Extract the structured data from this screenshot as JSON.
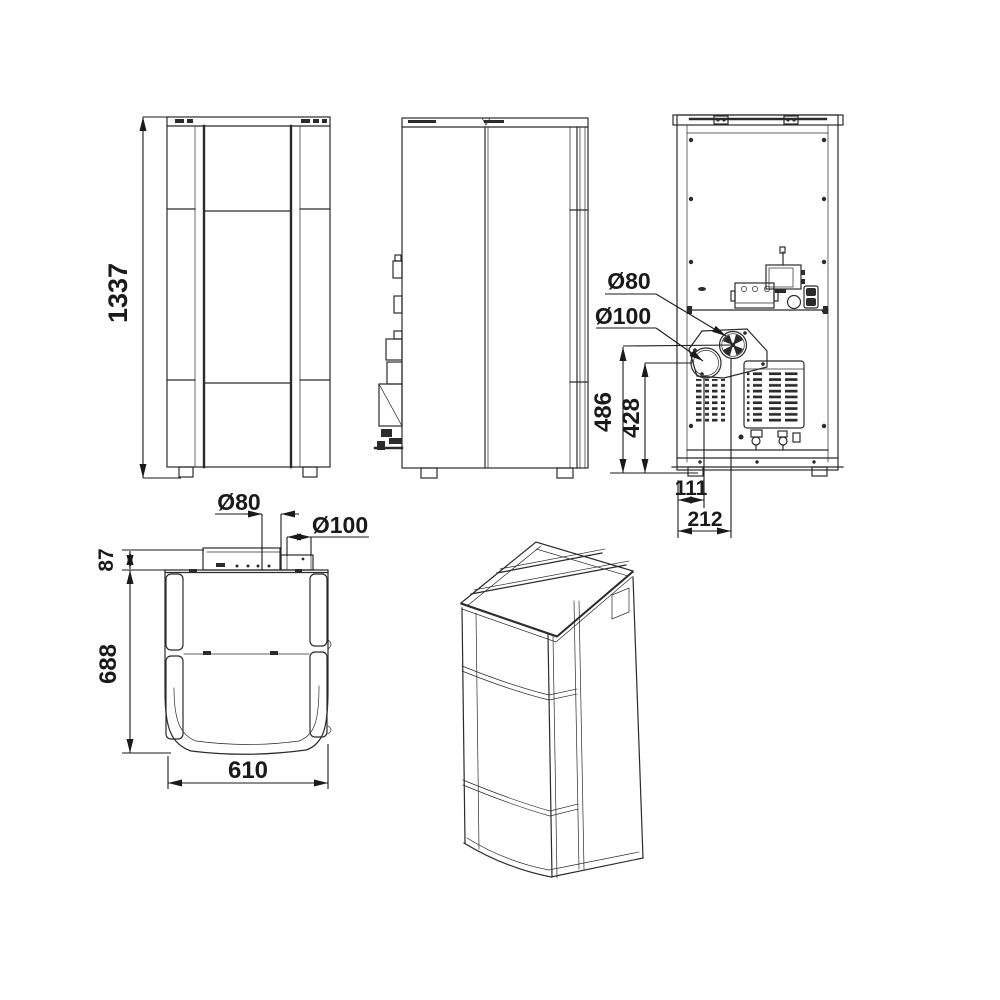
{
  "drawing": {
    "type": "technical-multiview",
    "subject": "pellet stove dimensional drawing",
    "line_color": "#2b2b2b",
    "background": "#ffffff"
  },
  "dims": {
    "front_height": "1337",
    "back_flue_diameter": "Ø80",
    "back_air_inlet_diameter": "Ø100",
    "back_flue_center_height": "486",
    "back_air_inlet_center_height": "428",
    "back_air_inlet_center_offset": "111",
    "back_flue_center_offset": "212",
    "top_flue_diameter": "Ø80",
    "top_air_inlet_diameter": "Ø100",
    "top_rear_depth": "87",
    "top_body_depth": "688",
    "top_width": "610"
  }
}
